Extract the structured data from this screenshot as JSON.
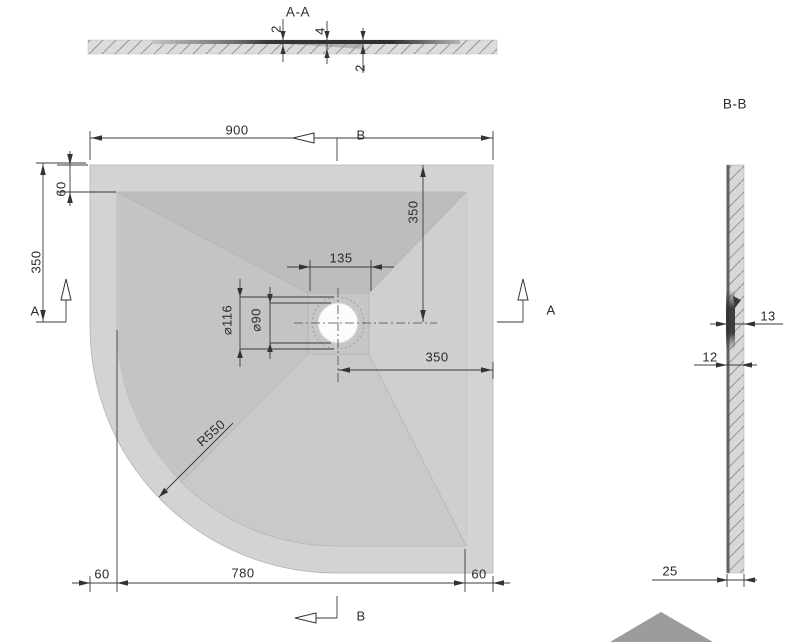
{
  "section_aa": {
    "label": "A-A",
    "dim_edge_left": "2",
    "dim_drain_depth": "4",
    "dim_edge_right": "2"
  },
  "plan": {
    "dim_width_top": "900",
    "dim_rim_top_left": "60",
    "dim_left_to_section": "350",
    "dim_top_to_drain": "350",
    "dim_drain_recess": "135",
    "dim_drain_outer_dia": "⌀116",
    "dim_drain_hole_dia": "⌀90",
    "dim_drain_to_right": "350",
    "dim_corner_radius": "R550",
    "dim_bottom_left_rim": "60",
    "dim_bottom_width": "780",
    "dim_bottom_right_rim": "60",
    "marker_a": "A",
    "marker_b": "B"
  },
  "section_bb": {
    "label": "B-B",
    "dim_lip": "13",
    "dim_body": "12",
    "dim_thickness": "25"
  },
  "colors": {
    "tray_rim": "#d3d3d3",
    "slope_top": "#bdbdbd",
    "slope_right": "#cfcfcf",
    "slope_bottom": "#c9c9c9",
    "slope_left": "#c4c4c4",
    "drain_square": "#c6c6c6",
    "drawing_line": "#3a3a3a",
    "floor_hatch_fill": "#dcdcdc",
    "section_dark_edge": "#3c3c3c",
    "iso_corner": "#9c9c9c"
  }
}
